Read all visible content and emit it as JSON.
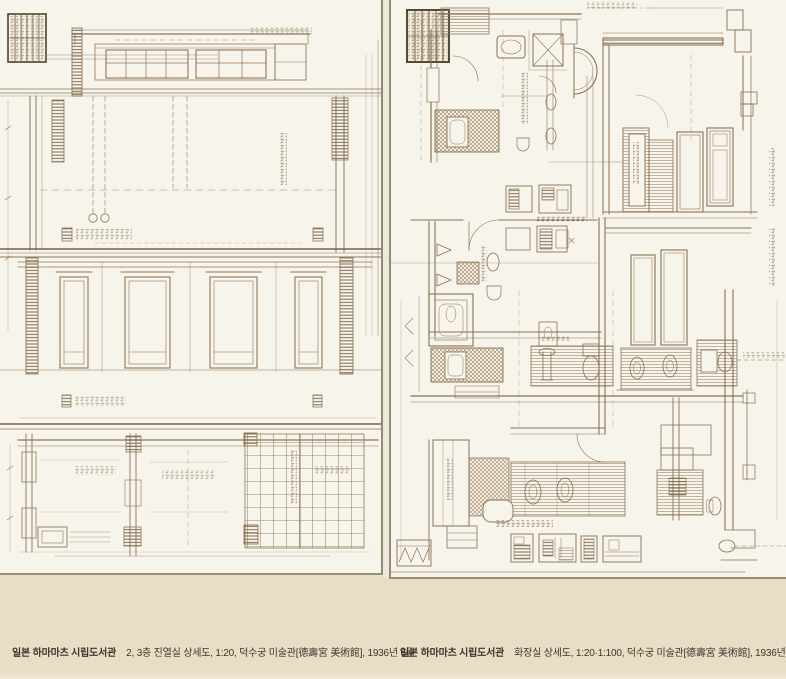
{
  "page": {
    "background_color": "#e9ddc6",
    "paper_color": "#f7f4ec",
    "ink_color": "#8b7355",
    "caption_color": "#3e352a"
  },
  "plates": [
    {
      "caption_source": "일본 하마마츠 시립도서관",
      "caption_description": "2, 3층 진열실 상세도, 1:20, 덕수궁 미술관[德壽宮 美術館], 1936년 6월"
    },
    {
      "caption_source": "일본 하마마츠 시립도서관",
      "caption_description": "화장실 상세도, 1:20·1:100, 덕수궁 미술관[德壽宮 美術館], 1936년 6월"
    }
  ]
}
